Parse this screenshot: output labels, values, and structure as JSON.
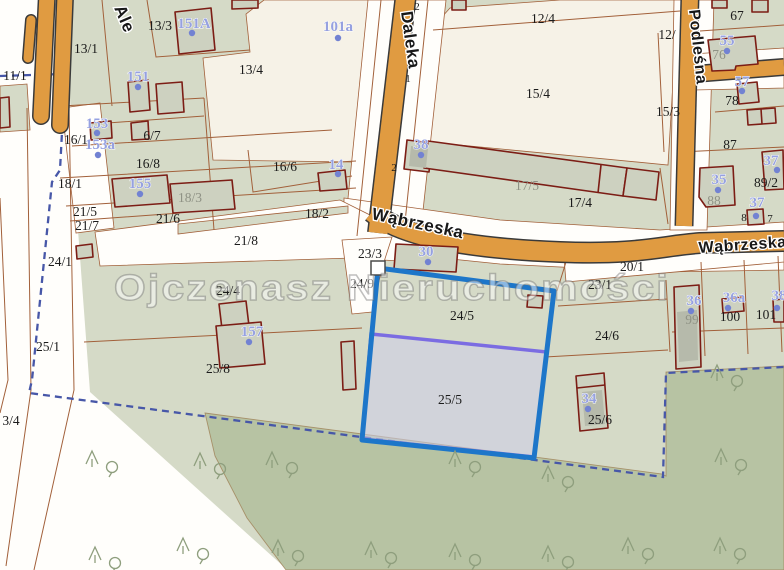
{
  "map": {
    "watermark": "Ojczenasz Nieruchomości",
    "highlighted_parcel": "25/5",
    "colors": {
      "parcel_green": "#d5dac7",
      "cream": "#f6f2e7",
      "road_white": "#fffefb",
      "forest_green": "#b7c3a3",
      "road_orange": "#e09b41",
      "boundary_brown": "#a2603a",
      "building_red": "#7c1d15",
      "building_fill": "#cdd1c0",
      "municipal_dash_blue": "#4757a8",
      "selection_blue": "#1d76c9",
      "highlight_purple": "#7b6ce2",
      "highlight_fill": "rgba(206,206,234,0.55)",
      "address_blue": "#96a1e0",
      "gray_label": "#8f9285"
    },
    "streets": [
      {
        "name": "Ale",
        "x": 114,
        "y": 8,
        "rotate": 67,
        "size": 17
      },
      {
        "name": "Daleka",
        "x": 401,
        "y": 12,
        "rotate": 82,
        "size": 17
      },
      {
        "name": "Wąbrzeska",
        "x": 371,
        "y": 219,
        "rotate": 12,
        "size": 17
      },
      {
        "name": "Wąbrzeska",
        "x": 699,
        "y": 253,
        "rotate": -4,
        "size": 16
      },
      {
        "name": "Podleśna",
        "x": 689,
        "y": 10,
        "rotate": 84,
        "size": 16
      }
    ],
    "parcel_labels": [
      {
        "text": "13/3",
        "x": 160,
        "y": 30
      },
      {
        "text": "13/1",
        "x": 86,
        "y": 53
      },
      {
        "text": "13/4",
        "x": 251,
        "y": 74
      },
      {
        "text": "11/1",
        "x": 15,
        "y": 80
      },
      {
        "text": "12/4",
        "x": 543,
        "y": 23
      },
      {
        "text": "15/4",
        "x": 538,
        "y": 98
      },
      {
        "text": "15/3",
        "x": 668,
        "y": 116
      },
      {
        "text": "12/",
        "x": 667,
        "y": 39
      },
      {
        "text": "67",
        "x": 737,
        "y": 20
      },
      {
        "text": "76",
        "x": 719,
        "y": 59,
        "gray": true
      },
      {
        "text": "78",
        "x": 732,
        "y": 105
      },
      {
        "text": "87",
        "x": 730,
        "y": 149
      },
      {
        "text": "88",
        "x": 714,
        "y": 205,
        "gray": true
      },
      {
        "text": "89/2",
        "x": 766,
        "y": 187
      },
      {
        "text": "16/1",
        "x": 76,
        "y": 144
      },
      {
        "text": "6/7",
        "x": 152,
        "y": 140
      },
      {
        "text": "16/8",
        "x": 148,
        "y": 168
      },
      {
        "text": "16/6",
        "x": 285,
        "y": 171
      },
      {
        "text": "18/1",
        "x": 70,
        "y": 188
      },
      {
        "text": "18/3",
        "x": 190,
        "y": 202,
        "gray": true
      },
      {
        "text": "18/2",
        "x": 317,
        "y": 218
      },
      {
        "text": "21/5",
        "x": 85,
        "y": 216
      },
      {
        "text": "21/7",
        "x": 87,
        "y": 230
      },
      {
        "text": "21/6",
        "x": 168,
        "y": 223
      },
      {
        "text": "21/8",
        "x": 246,
        "y": 245
      },
      {
        "text": "23/3",
        "x": 370,
        "y": 258
      },
      {
        "text": "24/9",
        "x": 362,
        "y": 288
      },
      {
        "text": "24/1",
        "x": 60,
        "y": 266
      },
      {
        "text": "24/4",
        "x": 228,
        "y": 295
      },
      {
        "text": "20/1",
        "x": 632,
        "y": 271
      },
      {
        "text": "23/1",
        "x": 600,
        "y": 289
      },
      {
        "text": "17/5",
        "x": 527,
        "y": 190,
        "gray": true
      },
      {
        "text": "17/4",
        "x": 580,
        "y": 207
      },
      {
        "text": "24/5",
        "x": 462,
        "y": 320
      },
      {
        "text": "24/6",
        "x": 607,
        "y": 340
      },
      {
        "text": "25/1",
        "x": 48,
        "y": 351
      },
      {
        "text": "25/8",
        "x": 218,
        "y": 373
      },
      {
        "text": "25/5",
        "x": 450,
        "y": 404
      },
      {
        "text": "25/6",
        "x": 600,
        "y": 424
      },
      {
        "text": "3/4",
        "x": 11,
        "y": 425
      },
      {
        "text": "99",
        "x": 692,
        "y": 324,
        "gray": true
      },
      {
        "text": "100",
        "x": 730,
        "y": 321
      },
      {
        "text": "101",
        "x": 766,
        "y": 319
      }
    ],
    "small_labels": [
      {
        "text": "2",
        "x": 417,
        "y": 10
      },
      {
        "text": "1",
        "x": 408,
        "y": 82
      },
      {
        "text": "2",
        "x": 394,
        "y": 171
      },
      {
        "text": "8",
        "x": 744,
        "y": 221
      },
      {
        "text": "7",
        "x": 770,
        "y": 222
      }
    ],
    "building_labels": [
      {
        "text": "151A",
        "x": 194,
        "y": 28,
        "dot_x": 192,
        "dot_y": 33
      },
      {
        "text": "101a",
        "x": 338,
        "y": 31,
        "dot_x": 338,
        "dot_y": 38
      },
      {
        "text": "151",
        "x": 138,
        "y": 81,
        "dot_x": 138,
        "dot_y": 87
      },
      {
        "text": "153",
        "x": 97,
        "y": 128,
        "dot_x": 97,
        "dot_y": 133
      },
      {
        "text": "153a",
        "x": 100,
        "y": 149,
        "dot_x": 98,
        "dot_y": 155
      },
      {
        "text": "155",
        "x": 140,
        "y": 188,
        "dot_x": 140,
        "dot_y": 194
      },
      {
        "text": "14",
        "x": 336,
        "y": 169,
        "dot_x": 338,
        "dot_y": 174
      },
      {
        "text": "38",
        "x": 421,
        "y": 149,
        "dot_x": 421,
        "dot_y": 155
      },
      {
        "text": "30",
        "x": 426,
        "y": 256,
        "dot_x": 428,
        "dot_y": 262
      },
      {
        "text": "157",
        "x": 252,
        "y": 336,
        "dot_x": 249,
        "dot_y": 342
      },
      {
        "text": "34",
        "x": 589,
        "y": 403,
        "dot_x": 588,
        "dot_y": 409
      },
      {
        "text": "55",
        "x": 727,
        "y": 45,
        "dot_x": 727,
        "dot_y": 51
      },
      {
        "text": "57",
        "x": 742,
        "y": 86,
        "dot_x": 742,
        "dot_y": 91
      },
      {
        "text": "35",
        "x": 719,
        "y": 184,
        "dot_x": 718,
        "dot_y": 190
      },
      {
        "text": "37",
        "x": 771,
        "y": 165,
        "dot_x": 777,
        "dot_y": 170
      },
      {
        "text": "37",
        "x": 757,
        "y": 207,
        "dot_x": 756,
        "dot_y": 216
      },
      {
        "text": "36",
        "x": 694,
        "y": 305,
        "dot_x": 691,
        "dot_y": 311
      },
      {
        "text": "36a",
        "x": 734,
        "y": 302,
        "dot_x": 728,
        "dot_y": 308
      },
      {
        "text": "38",
        "x": 779,
        "y": 300,
        "dot_x": 777,
        "dot_y": 308
      }
    ],
    "trees": [
      {
        "x": 92,
        "y": 458
      },
      {
        "x": 200,
        "y": 460
      },
      {
        "x": 272,
        "y": 459
      },
      {
        "x": 455,
        "y": 458
      },
      {
        "x": 548,
        "y": 473
      },
      {
        "x": 717,
        "y": 372
      },
      {
        "x": 721,
        "y": 456
      },
      {
        "x": 95,
        "y": 554
      },
      {
        "x": 183,
        "y": 545
      },
      {
        "x": 278,
        "y": 547
      },
      {
        "x": 371,
        "y": 549
      },
      {
        "x": 455,
        "y": 551
      },
      {
        "x": 548,
        "y": 553
      },
      {
        "x": 628,
        "y": 545
      },
      {
        "x": 720,
        "y": 545
      }
    ]
  }
}
